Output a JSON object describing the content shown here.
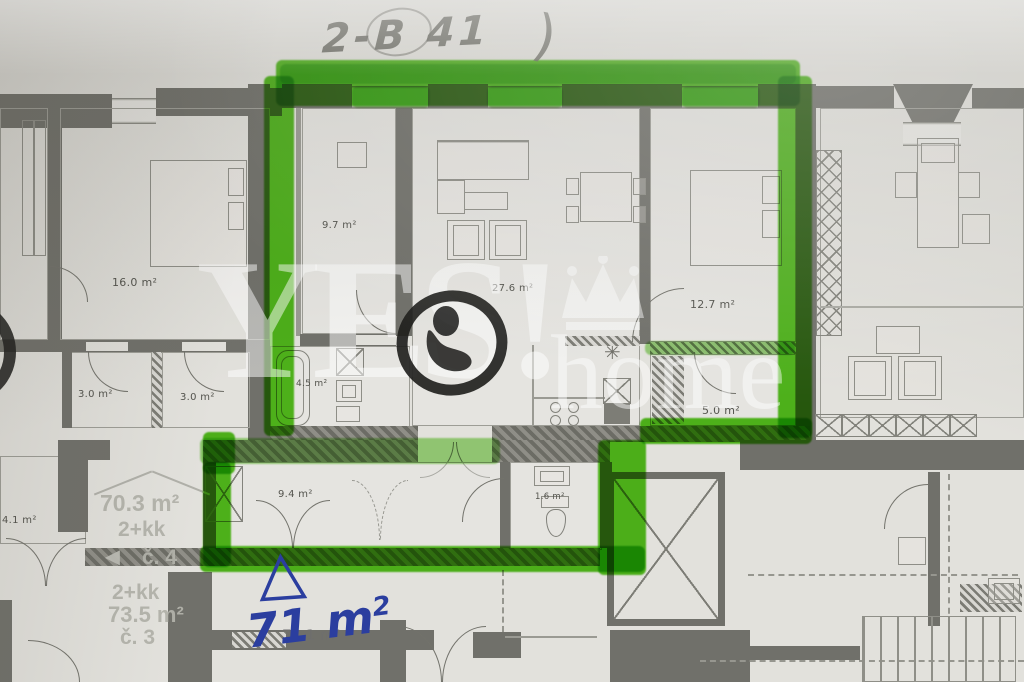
{
  "photo": {
    "type": "floor-plan",
    "colors": {
      "highlighter_green": "#55c51d",
      "ink_blue": "#2b3e9f",
      "pencil_gray": "#65655e",
      "stamp_black": "#1d1d1b",
      "wall_gray": "#70706a",
      "paper": "#e2e1dc"
    }
  },
  "handwriting": {
    "unit_code": "2-B 41",
    "closing_paren": ")",
    "area_value": "71 m",
    "area_sup": "2"
  },
  "watermark": {
    "brand_top": "YES!",
    "brand_bottom": "home"
  },
  "highlighted_unit": {
    "bedroom_small": "9.7 m²",
    "living_kitchen": "27.6 m²",
    "bedroom_large": "12.7 m²",
    "bathroom": "4.5 m²",
    "storage": "5.0 m²",
    "hallway": "9.4 m²",
    "wc": "1.6 m²",
    "printed_area": "70.1 m²"
  },
  "neighbor_left_unit": {
    "bedroom": "16.0 m²",
    "room_a": "3.0 m²",
    "room_b": "3.0 m²",
    "closet": "4.1 m²"
  },
  "stairwell_labels": {
    "unit4_area": "70.3 m²",
    "unit4_layout": "2+kk",
    "unit4_number": "č. 4",
    "unit3_layout": "2+kk",
    "unit3_area": "73.5 m²",
    "unit3_number": "č. 3",
    "arrow_icon": "◄"
  },
  "icons": {
    "boiler_symbol": "✳"
  }
}
